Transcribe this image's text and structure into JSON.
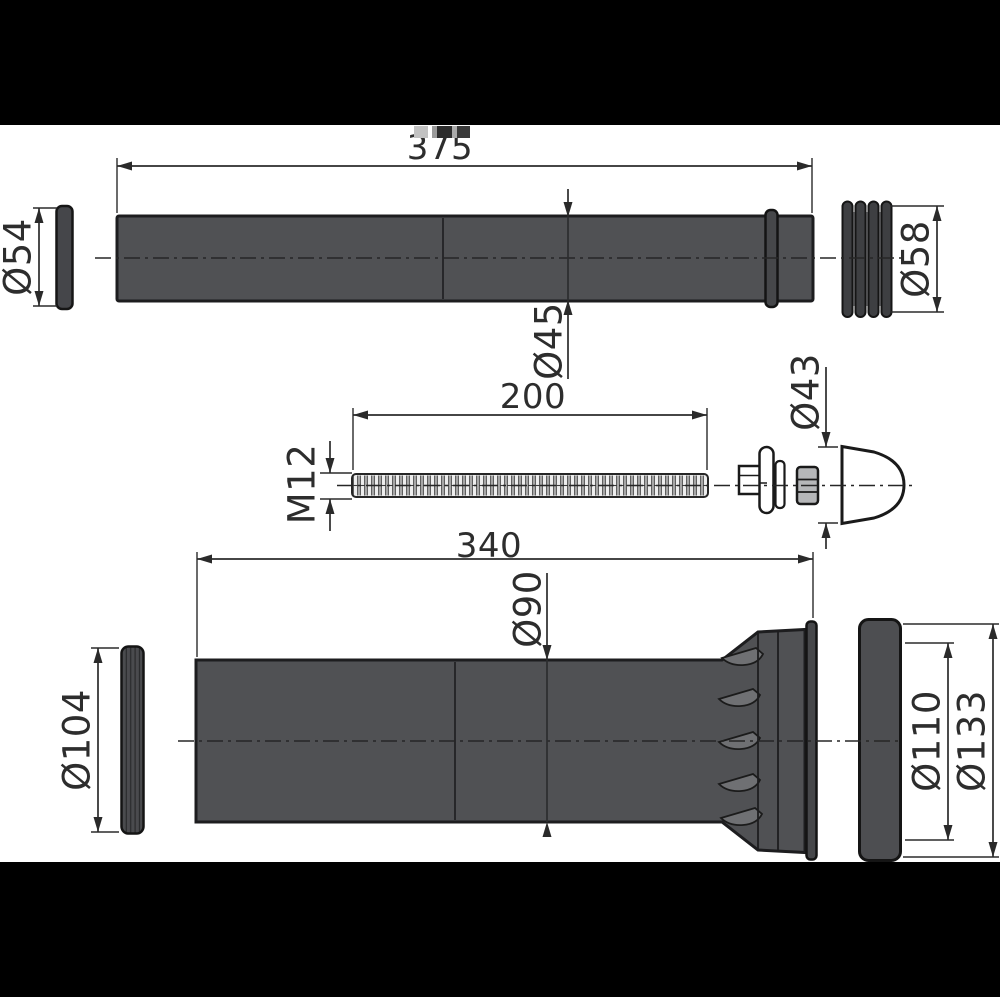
{
  "diagram": {
    "type": "technical-drawing",
    "views": {
      "top_pipe": {
        "length": "375",
        "gasket_dia": "Ø54",
        "pipe_dia": "Ø45",
        "sleeve_dia": "Ø58"
      },
      "threaded_rod": {
        "length": "200",
        "thread": "M12",
        "cone_dia": "Ø43"
      },
      "bottom_pipe": {
        "length": "340",
        "pipe_dia": "Ø90",
        "gasket_dia": "Ø104",
        "collar_inner_dia": "Ø110",
        "collar_outer_dia": "Ø133"
      }
    },
    "colors": {
      "background": "#ffffff",
      "band": "#000000",
      "part_gray": "#505154",
      "dark_gray": "#45464a",
      "light_part": "#ededed",
      "line": "#2b2b2b"
    }
  }
}
